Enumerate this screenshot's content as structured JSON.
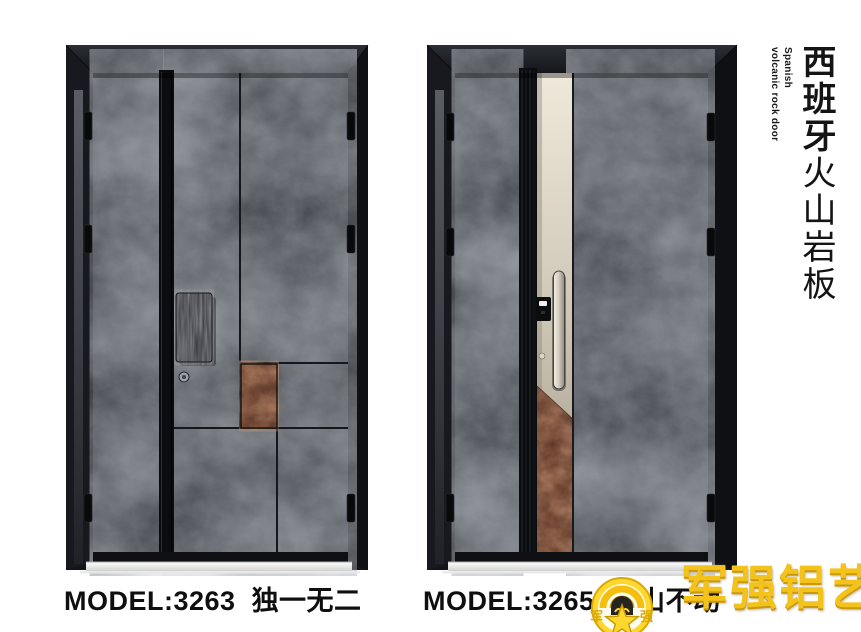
{
  "page": {
    "background": "#ffffff"
  },
  "side_title": {
    "cn_bold": "西班牙",
    "cn_light": "火山岩板",
    "en_line1": "Spanish",
    "en_line2": "volcanic rock door"
  },
  "products": [
    {
      "model": "MODEL:3263",
      "name": "独一无二"
    },
    {
      "model": "MODEL:3265",
      "name": "层山不动"
    }
  ],
  "logo": {
    "badge_left": "军",
    "badge_right": "强",
    "wordmark": "军强铝艺"
  },
  "colors": {
    "gold": "#f4c31b",
    "volcanic_rock": "#43464c",
    "rust_accent": "#7e452f",
    "champagne_strip": "#ddd6c6",
    "frame_black": "#15171b",
    "text_black": "#111111"
  }
}
